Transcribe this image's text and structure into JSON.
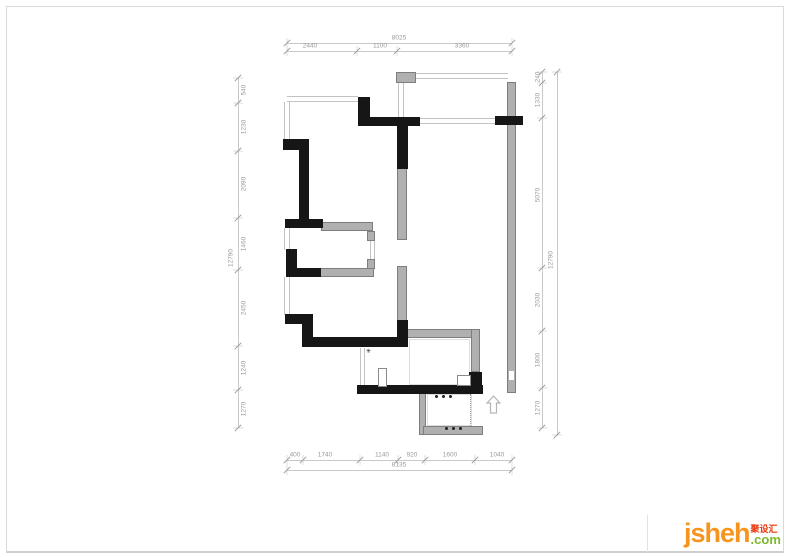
{
  "page": {
    "bg": "#ffffff",
    "frame_color": "#dadada"
  },
  "watermark": {
    "main": "jsheh",
    "cn": "聚设汇",
    "suffix": ".com",
    "main_color": "#F7941E",
    "cn_color": "#E8380D",
    "suffix_color": "#7DB928"
  },
  "plan": {
    "black_color": "#161616",
    "gray_color": "#b0b0b0",
    "window_color": "#c2c2c2",
    "walls_black": [
      [
        358,
        97,
        12,
        28
      ],
      [
        358,
        117,
        62,
        9
      ],
      [
        397,
        125,
        11,
        44
      ],
      [
        283,
        139,
        26,
        11
      ],
      [
        299,
        139,
        10,
        89
      ],
      [
        285,
        219,
        38,
        9
      ],
      [
        286,
        249,
        11,
        28
      ],
      [
        286,
        268,
        35,
        9
      ],
      [
        285,
        314,
        28,
        10
      ],
      [
        302,
        314,
        11,
        33
      ],
      [
        302,
        337,
        106,
        10
      ],
      [
        397,
        320,
        11,
        27
      ],
      [
        357,
        385,
        126,
        9
      ],
      [
        469,
        372,
        13,
        14
      ],
      [
        495,
        116,
        28,
        9
      ]
    ],
    "walls_gray": [
      [
        396,
        72,
        20,
        11
      ],
      [
        507,
        82,
        9,
        311
      ],
      [
        321,
        222,
        52,
        9
      ],
      [
        367,
        231,
        8,
        10
      ],
      [
        319,
        268,
        55,
        9
      ],
      [
        367,
        259,
        8,
        10
      ],
      [
        397,
        168,
        10,
        72
      ],
      [
        397,
        266,
        10,
        56
      ],
      [
        407,
        329,
        73,
        9
      ],
      [
        471,
        329,
        9,
        43
      ],
      [
        419,
        392,
        7,
        43
      ],
      [
        423,
        426,
        60,
        9
      ]
    ],
    "windows_h": [
      [
        287,
        96,
        71,
        6
      ],
      [
        415,
        73,
        93,
        6
      ],
      [
        420,
        118,
        75,
        6
      ]
    ],
    "windows_v": [
      [
        284,
        102,
        6,
        38
      ],
      [
        398,
        83,
        6,
        35
      ],
      [
        284,
        228,
        6,
        22
      ],
      [
        284,
        277,
        6,
        38
      ],
      [
        370,
        241,
        5,
        28
      ],
      [
        360,
        348,
        5,
        38
      ]
    ],
    "faint_rects": [
      [
        409,
        339,
        61,
        46
      ],
      [
        427,
        394,
        45,
        32
      ]
    ],
    "dots": [
      [
        436,
        396
      ],
      [
        443,
        396
      ],
      [
        450,
        396
      ],
      [
        446,
        428
      ],
      [
        453,
        428
      ],
      [
        460,
        428
      ]
    ],
    "fixtures": [
      [
        457,
        375,
        14,
        11
      ],
      [
        378,
        368,
        9,
        19
      ]
    ],
    "wall_gaps": [
      [
        509,
        371,
        5,
        9
      ]
    ],
    "dashed": {
      "x": 470,
      "y1": 394,
      "y2": 426
    },
    "marker": {
      "x": 366,
      "y": 349,
      "glyph": "✳"
    }
  },
  "dims": {
    "h_chains": [
      {
        "y": 43,
        "x1": 287,
        "x2": 512,
        "ticks": [
          287,
          512
        ],
        "labels": [
          {
            "t": "8025",
            "x": 399
          }
        ]
      },
      {
        "y": 51,
        "x1": 287,
        "x2": 512,
        "ticks": [
          287,
          357,
          397,
          512
        ],
        "labels": [
          {
            "t": "2440",
            "x": 310
          },
          {
            "t": "1100",
            "x": 380
          },
          {
            "t": "3360",
            "x": 462
          }
        ]
      },
      {
        "y": 460,
        "x1": 287,
        "x2": 512,
        "ticks": [
          287,
          303,
          360,
          398,
          425,
          475,
          512
        ],
        "labels": [
          {
            "t": "400",
            "x": 295
          },
          {
            "t": "1740",
            "x": 325
          },
          {
            "t": "1140",
            "x": 382
          },
          {
            "t": "920",
            "x": 412
          },
          {
            "t": "1600",
            "x": 450
          },
          {
            "t": "1040",
            "x": 497
          }
        ]
      },
      {
        "y": 470,
        "x1": 287,
        "x2": 512,
        "ticks": [
          287,
          512
        ],
        "labels": [
          {
            "t": "8135",
            "x": 399
          }
        ]
      }
    ],
    "v_chains": [
      {
        "x": 238,
        "y1": 78,
        "y2": 428,
        "lx": 244,
        "ticks": [
          78,
          103,
          151,
          218,
          270,
          346,
          390,
          428
        ],
        "labels": [
          {
            "t": "540",
            "y": 90
          },
          {
            "t": "1230",
            "y": 127
          },
          {
            "t": "2090",
            "y": 184
          },
          {
            "t": "1460",
            "y": 244
          },
          {
            "t": "2450",
            "y": 308
          },
          {
            "t": "1240",
            "y": 368
          },
          {
            "t": "1270",
            "y": 409
          }
        ]
      },
      {
        "x": 542,
        "y1": 72,
        "y2": 428,
        "lx": 538,
        "ticks": [
          72,
          83,
          118,
          268,
          331,
          388,
          428
        ],
        "labels": [
          {
            "t": "240",
            "y": 77
          },
          {
            "t": "1330",
            "y": 100
          },
          {
            "t": "5070",
            "y": 195
          },
          {
            "t": "2030",
            "y": 300
          },
          {
            "t": "1800",
            "y": 360
          },
          {
            "t": "1270",
            "y": 408
          }
        ]
      },
      {
        "x": 557,
        "y1": 72,
        "y2": 435,
        "lx": 551,
        "ticks": [
          72,
          435
        ],
        "labels": [
          {
            "t": "12790",
            "y": 260
          }
        ]
      }
    ],
    "free_labels": [
      {
        "t": "12790",
        "x": 231,
        "y": 258
      }
    ]
  }
}
